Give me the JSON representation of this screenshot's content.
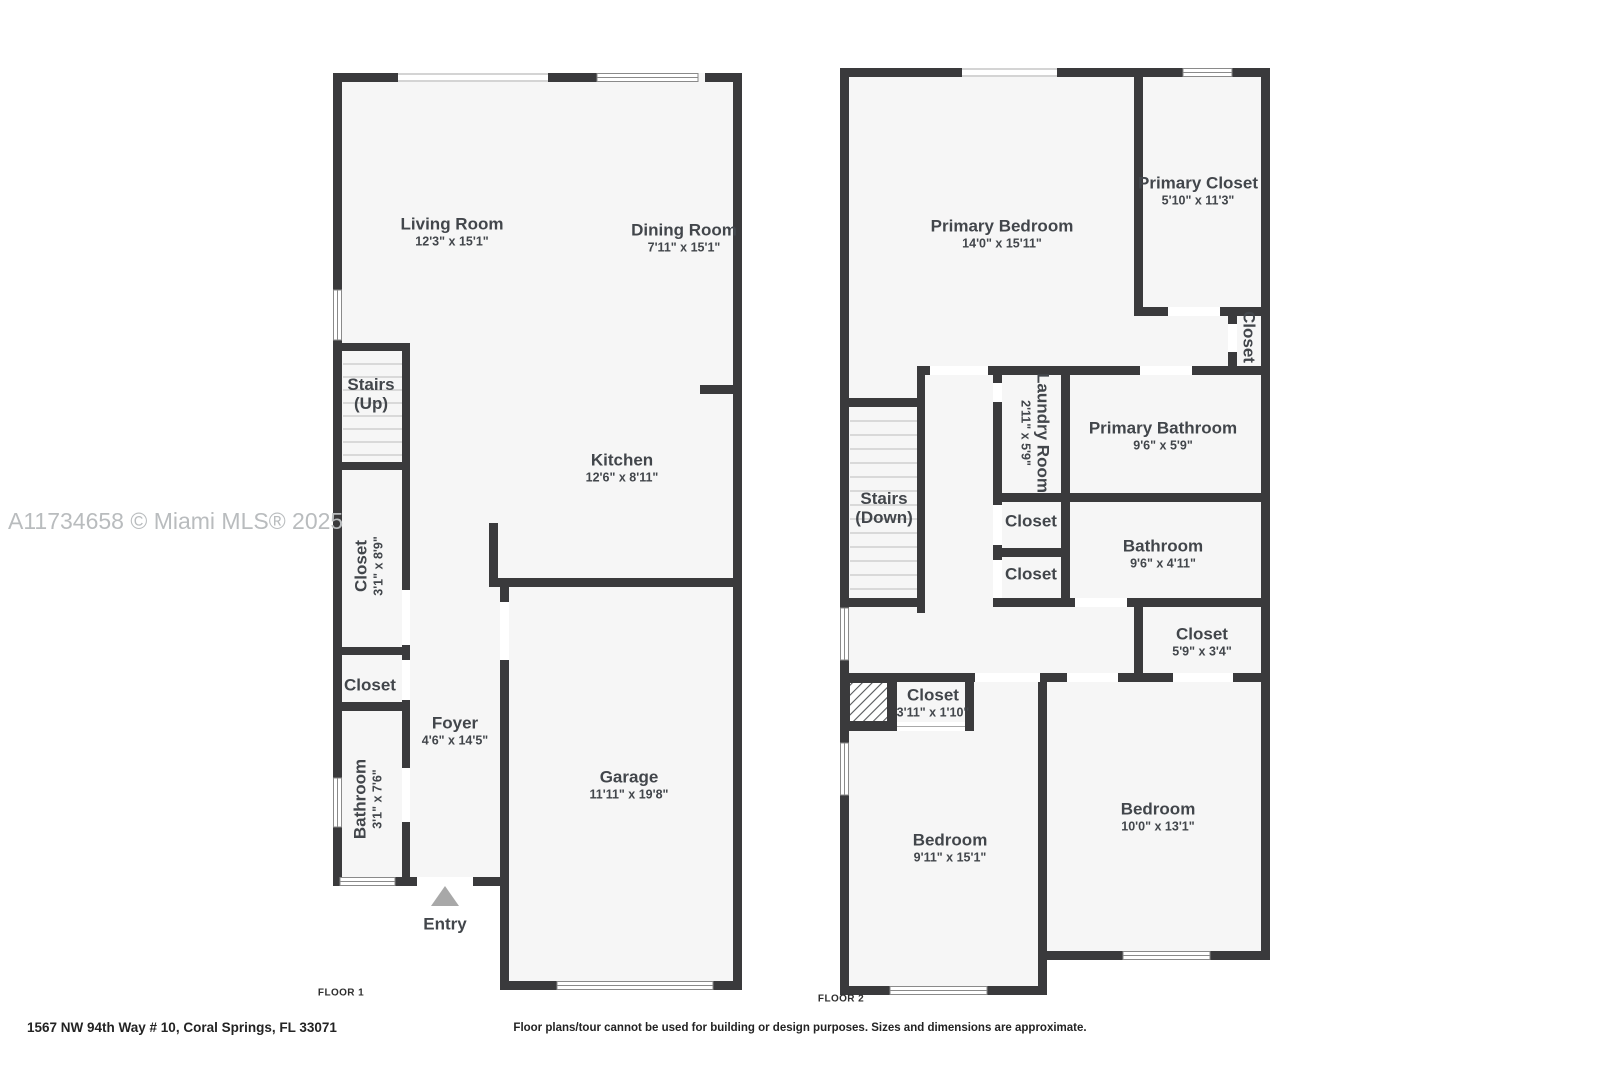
{
  "watermark": "A11734658 © Miami MLS® 2025",
  "footer": {
    "address": "1567 NW 94th Way # 10, Coral Springs, FL 33071",
    "disclaimer": "Floor plans/tour cannot be used for building or design purposes. Sizes and dimensions are approximate."
  },
  "colors": {
    "wall": "#3a3a3c",
    "floor": "#f6f6f6",
    "label": "#42464b",
    "watermark": "#b9bcbe",
    "entry_arrow": "#a8a8a8"
  },
  "floor1": {
    "floor_label": "FLOOR 1",
    "entry_label": "Entry",
    "rooms": {
      "living": {
        "name": "Living Room",
        "dims": "12'3\" x 15'1\""
      },
      "dining": {
        "name": "Dining Room",
        "dims": "7'11\" x 15'1\""
      },
      "kitchen": {
        "name": "Kitchen",
        "dims": "12'6\" x 8'11\""
      },
      "garage": {
        "name": "Garage",
        "dims": "11'11\" x 19'8\""
      },
      "foyer": {
        "name": "Foyer",
        "dims": "4'6\" x 14'5\""
      },
      "stairs": {
        "line1": "Stairs",
        "line2": "(Up)"
      },
      "closet_tall": {
        "name": "Closet",
        "dims": "3'1\" x 8'9\""
      },
      "closet_small": {
        "name": "Closet"
      },
      "bathroom": {
        "name": "Bathroom",
        "dims": "3'1\" x 7'6\""
      }
    }
  },
  "floor2": {
    "floor_label": "FLOOR 2",
    "rooms": {
      "primary_bedroom": {
        "name": "Primary Bedroom",
        "dims": "14'0\" x 15'11\""
      },
      "primary_closet": {
        "name": "Primary Closet",
        "dims": "5'10\" x 11'3\""
      },
      "closet_side": {
        "name": "Closet"
      },
      "laundry": {
        "name": "Laundry Room",
        "dims": "2'11\" x 5'9\""
      },
      "primary_bathroom": {
        "name": "Primary Bathroom",
        "dims": "9'6\" x 5'9\""
      },
      "stairs": {
        "line1": "Stairs",
        "line2": "(Down)"
      },
      "closet_hall1": {
        "name": "Closet"
      },
      "closet_hall2": {
        "name": "Closet"
      },
      "bathroom": {
        "name": "Bathroom",
        "dims": "9'6\" x 4'11\""
      },
      "closet_bed2": {
        "name": "Closet",
        "dims": "5'9\" x 3'4\""
      },
      "closet_bed1": {
        "name": "Closet",
        "dims": "3'11\" x 1'10\""
      },
      "bedroom1": {
        "name": "Bedroom",
        "dims": "9'11\" x 15'1\""
      },
      "bedroom2": {
        "name": "Bedroom",
        "dims": "10'0\" x 13'1\""
      }
    }
  }
}
